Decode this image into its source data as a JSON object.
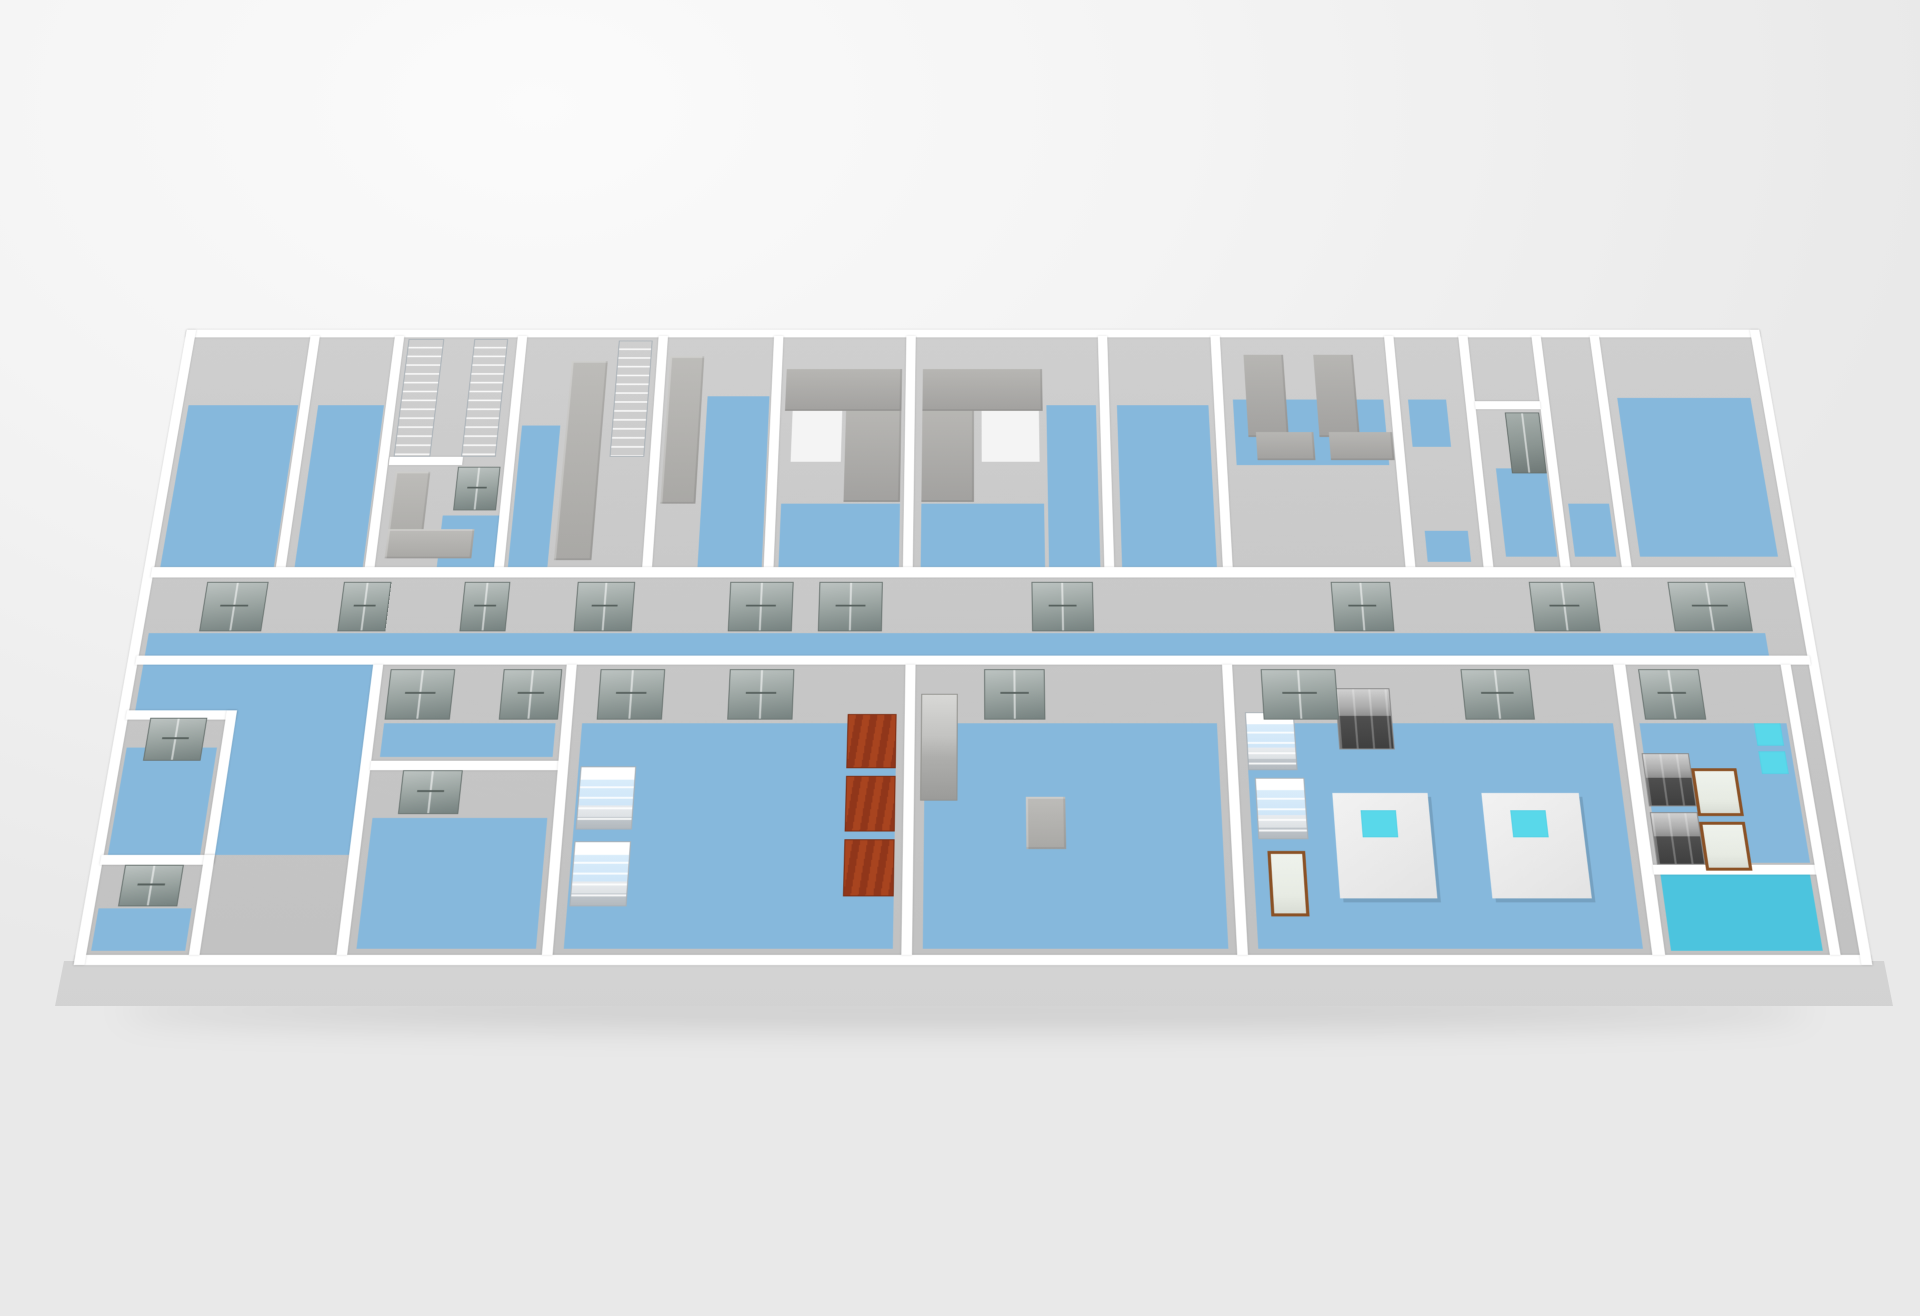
{
  "meta": {
    "view": "isometric-floor-plan",
    "building": "laboratory-floor"
  },
  "palette": {
    "wall": "#ffffff",
    "blue": "#86b8dc",
    "teal": "#4cc4de",
    "cyan": "#59d8ea",
    "wood": "#8a5125",
    "floor": "#c9c9c9",
    "door": "#97a19e",
    "red_shelf": "#a8441f",
    "background": "#f2f2f2"
  },
  "scene": {
    "plan_width": 1678,
    "plan_height": 710,
    "shapes": [
      {
        "name": "floor-base",
        "cls": "floor-base",
        "x": 10,
        "y": 10,
        "w": 1658,
        "h": 690
      },
      {
        "name": "room-a-floor",
        "cls": "blue",
        "x": 16,
        "y": 95,
        "w": 115,
        "h": 193
      },
      {
        "name": "room-b-floor",
        "cls": "blue",
        "x": 152,
        "y": 95,
        "w": 69,
        "h": 193
      },
      {
        "name": "room-c-floor",
        "cls": "blue",
        "x": 296,
        "y": 228,
        "w": 58,
        "h": 60
      },
      {
        "name": "room-d-floor",
        "cls": "blue",
        "x": 368,
        "y": 120,
        "w": 40,
        "h": 168
      },
      {
        "name": "room-e-floor",
        "cls": "blue",
        "x": 560,
        "y": 84,
        "w": 65,
        "h": 204
      },
      {
        "name": "room-f-floor",
        "cls": "blue",
        "x": 642,
        "y": 214,
        "w": 122,
        "h": 74
      },
      {
        "name": "room-g-floor",
        "cls": "blue",
        "x": 786,
        "y": 214,
        "w": 126,
        "h": 74
      },
      {
        "name": "room-g2-floor",
        "cls": "blue",
        "x": 916,
        "y": 95,
        "w": 52,
        "h": 193
      },
      {
        "name": "room-h-floor",
        "cls": "blue",
        "x": 990,
        "y": 95,
        "w": 96,
        "h": 193
      },
      {
        "name": "room-i-rug",
        "cls": "rug",
        "x": 1112,
        "y": 88,
        "w": 158,
        "h": 80
      },
      {
        "name": "room-j-rug",
        "cls": "rug",
        "x": 1296,
        "y": 88,
        "w": 40,
        "h": 58
      },
      {
        "name": "room-j-rug-south",
        "cls": "rug",
        "x": 1300,
        "y": 246,
        "w": 44,
        "h": 36
      },
      {
        "name": "room-k-floor",
        "cls": "blue",
        "x": 1380,
        "y": 172,
        "w": 52,
        "h": 104
      },
      {
        "name": "strip-room-rug",
        "cls": "rug",
        "x": 1450,
        "y": 214,
        "w": 42,
        "h": 62
      },
      {
        "name": "room-l-floor",
        "cls": "blue",
        "x": 1516,
        "y": 86,
        "w": 140,
        "h": 190
      },
      {
        "name": "corridor-floor",
        "cls": "blue",
        "x": 16,
        "y": 363,
        "w": 1614,
        "h": 25
      },
      {
        "name": "lobby-floor-north",
        "cls": "blue",
        "x": 16,
        "y": 398,
        "w": 228,
        "h": 50
      },
      {
        "name": "lobby-floor-south",
        "cls": "blue",
        "x": 116,
        "y": 448,
        "w": 128,
        "h": 152
      },
      {
        "name": "small-room-1-floor",
        "cls": "blue",
        "x": 14,
        "y": 488,
        "w": 88,
        "h": 112
      },
      {
        "name": "small-room-2-floor",
        "cls": "blue",
        "x": 14,
        "y": 654,
        "w": 88,
        "h": 42
      },
      {
        "name": "room-b1-floor",
        "cls": "blue",
        "x": 262,
        "y": 462,
        "w": 168,
        "h": 36
      },
      {
        "name": "room-b1s-floor",
        "cls": "blue",
        "x": 262,
        "y": 562,
        "w": 168,
        "h": 132
      },
      {
        "name": "room-b2-floor",
        "cls": "blue",
        "x": 456,
        "y": 462,
        "w": 308,
        "h": 232
      },
      {
        "name": "room-b3-floor",
        "cls": "blue",
        "x": 792,
        "y": 462,
        "w": 286,
        "h": 232
      },
      {
        "name": "room-b4-floor",
        "cls": "blue",
        "x": 1106,
        "y": 462,
        "w": 360,
        "h": 232
      },
      {
        "name": "room-b5-floor",
        "cls": "blue",
        "x": 1492,
        "y": 462,
        "w": 144,
        "h": 146
      },
      {
        "name": "room-b5-teal-floor",
        "cls": "teal",
        "x": 1492,
        "y": 620,
        "w": 142,
        "h": 76
      },
      {
        "name": "room-f-inner-patch",
        "cls": "white-patch",
        "x": 650,
        "y": 102,
        "w": 52,
        "h": 62
      },
      {
        "name": "room-g-inner-patch",
        "cls": "white-patch",
        "x": 848,
        "y": 102,
        "w": 60,
        "h": 62
      },
      {
        "name": "outer-wall-top",
        "cls": "wall",
        "x": 0,
        "y": 0,
        "w": 1678,
        "h": 10
      },
      {
        "name": "outer-wall-bottom",
        "cls": "wall",
        "x": 0,
        "y": 700,
        "w": 1678,
        "h": 10
      },
      {
        "name": "outer-wall-left",
        "cls": "wall",
        "x": 0,
        "y": 0,
        "w": 10,
        "h": 710
      },
      {
        "name": "outer-wall-right",
        "cls": "wall",
        "x": 1668,
        "y": 0,
        "w": 10,
        "h": 710
      },
      {
        "name": "wall-top-ab",
        "cls": "wall",
        "x": 133,
        "y": 8,
        "w": 10,
        "h": 280
      },
      {
        "name": "wall-top-bc",
        "cls": "wall",
        "x": 223,
        "y": 8,
        "w": 10,
        "h": 280
      },
      {
        "name": "wall-top-cd",
        "cls": "wall",
        "x": 354,
        "y": 8,
        "w": 10,
        "h": 280
      },
      {
        "name": "wall-top-de",
        "cls": "wall",
        "x": 504,
        "y": 8,
        "w": 10,
        "h": 280
      },
      {
        "name": "wall-top-ef",
        "cls": "wall",
        "x": 627,
        "y": 8,
        "w": 10,
        "h": 280
      },
      {
        "name": "wall-top-fg",
        "cls": "wall",
        "x": 768,
        "y": 8,
        "w": 10,
        "h": 280
      },
      {
        "name": "wall-top-gh",
        "cls": "wall",
        "x": 972,
        "y": 8,
        "w": 10,
        "h": 280
      },
      {
        "name": "wall-top-hi",
        "cls": "wall",
        "x": 1092,
        "y": 8,
        "w": 10,
        "h": 280
      },
      {
        "name": "wall-top-ij",
        "cls": "wall",
        "x": 1277,
        "y": 8,
        "w": 10,
        "h": 280
      },
      {
        "name": "wall-top-jk",
        "cls": "wall",
        "x": 1356,
        "y": 8,
        "w": 10,
        "h": 280
      },
      {
        "name": "wall-top-k-strip",
        "cls": "wall",
        "x": 1434,
        "y": 8,
        "w": 10,
        "h": 280
      },
      {
        "name": "wall-top-strip-l",
        "cls": "wall",
        "x": 1496,
        "y": 8,
        "w": 10,
        "h": 280
      },
      {
        "name": "wall-room-c-alcove",
        "cls": "wall",
        "x": 234,
        "y": 158,
        "w": 76,
        "h": 10
      },
      {
        "name": "wall-room-k-split",
        "cls": "wall",
        "x": 1366,
        "y": 90,
        "w": 68,
        "h": 10
      },
      {
        "name": "wall-corridor-north",
        "cls": "wall",
        "x": 8,
        "y": 288,
        "w": 1662,
        "h": 12
      },
      {
        "name": "wall-corridor-south",
        "cls": "wall",
        "x": 8,
        "y": 388,
        "w": 1662,
        "h": 10
      },
      {
        "name": "wall-small-room-top",
        "cls": "wall",
        "x": 8,
        "y": 448,
        "w": 108,
        "h": 10
      },
      {
        "name": "wall-small-room-right",
        "cls": "wall",
        "x": 106,
        "y": 448,
        "w": 10,
        "h": 160
      },
      {
        "name": "wall-small-room-mid",
        "cls": "wall",
        "x": 8,
        "y": 600,
        "w": 108,
        "h": 10
      },
      {
        "name": "wall-small-room2-right",
        "cls": "wall",
        "x": 106,
        "y": 600,
        "w": 10,
        "h": 100
      },
      {
        "name": "wall-bottom-lobby-b1",
        "cls": "wall",
        "x": 244,
        "y": 398,
        "w": 10,
        "h": 302
      },
      {
        "name": "wall-room-b1-split",
        "cls": "wall",
        "x": 254,
        "y": 502,
        "w": 182,
        "h": 10
      },
      {
        "name": "wall-bottom-b1-b2",
        "cls": "wall",
        "x": 436,
        "y": 398,
        "w": 10,
        "h": 302
      },
      {
        "name": "wall-bottom-b2-b3",
        "cls": "wall",
        "x": 772,
        "y": 398,
        "w": 10,
        "h": 302
      },
      {
        "name": "wall-bottom-b3-b4",
        "cls": "wall",
        "x": 1086,
        "y": 398,
        "w": 10,
        "h": 302
      },
      {
        "name": "wall-bottom-b4-b5",
        "cls": "wall",
        "x": 1474,
        "y": 398,
        "w": 12,
        "h": 302
      },
      {
        "name": "wall-room-b5-split",
        "cls": "wall",
        "x": 1486,
        "y": 610,
        "w": 154,
        "h": 10
      },
      {
        "name": "wall-bottom-b5-east",
        "cls": "wall",
        "x": 1640,
        "y": 398,
        "w": 10,
        "h": 302
      },
      {
        "name": "lab-fridge-column-1",
        "cls": "fridge-col",
        "x": 238,
        "y": 12,
        "w": 38,
        "h": 146
      },
      {
        "name": "lab-fridge-column-2",
        "cls": "fridge-col",
        "x": 308,
        "y": 12,
        "w": 36,
        "h": 146
      },
      {
        "name": "lab-fridge-column-3",
        "cls": "fridge-col",
        "x": 462,
        "y": 14,
        "w": 36,
        "h": 144
      },
      {
        "name": "room-c-counter-vertical",
        "cls": "counter",
        "x": 242,
        "y": 176,
        "w": 36,
        "h": 100
      },
      {
        "name": "room-c-counter-horizontal",
        "cls": "counter",
        "x": 242,
        "y": 244,
        "w": 88,
        "h": 34
      },
      {
        "name": "room-d-tall-counter",
        "cls": "counter",
        "x": 414,
        "y": 40,
        "w": 38,
        "h": 240
      },
      {
        "name": "room-e-tall-counter",
        "cls": "counter",
        "x": 518,
        "y": 34,
        "w": 36,
        "h": 180
      },
      {
        "name": "room-f-bench-block",
        "cls": "bench",
        "x": 642,
        "y": 50,
        "w": 122,
        "h": 52
      },
      {
        "name": "room-f-bench-side",
        "cls": "bench",
        "x": 706,
        "y": 102,
        "w": 58,
        "h": 110
      },
      {
        "name": "room-g-bench-block",
        "cls": "bench",
        "x": 786,
        "y": 50,
        "w": 126,
        "h": 52
      },
      {
        "name": "room-g-bench-side",
        "cls": "bench",
        "x": 786,
        "y": 102,
        "w": 54,
        "h": 110
      },
      {
        "name": "room-i-bench-1",
        "cls": "bench",
        "x": 1126,
        "y": 32,
        "w": 42,
        "h": 102
      },
      {
        "name": "room-i-bench-1-foot",
        "cls": "bench",
        "x": 1134,
        "y": 128,
        "w": 60,
        "h": 34
      },
      {
        "name": "room-i-bench-2",
        "cls": "bench",
        "x": 1200,
        "y": 32,
        "w": 42,
        "h": 102
      },
      {
        "name": "room-i-bench-2-foot",
        "cls": "bench",
        "x": 1210,
        "y": 128,
        "w": 66,
        "h": 34
      },
      {
        "name": "room-k-cabinet",
        "cls": "cabinet",
        "x": 1396,
        "y": 104,
        "w": 36,
        "h": 74
      },
      {
        "name": "room-b2-fridge-1",
        "cls": "fridge",
        "x": 458,
        "y": 508,
        "w": 54,
        "h": 66
      },
      {
        "name": "room-b2-fridge-2",
        "cls": "fridge",
        "x": 458,
        "y": 586,
        "w": 54,
        "h": 66
      },
      {
        "name": "room-b2-red-shelf-1",
        "cls": "red-shelf",
        "x": 716,
        "y": 452,
        "w": 48,
        "h": 58
      },
      {
        "name": "room-b2-red-shelf-2",
        "cls": "red-shelf",
        "x": 716,
        "y": 518,
        "w": 48,
        "h": 58
      },
      {
        "name": "room-b2-red-shelf-3",
        "cls": "red-shelf",
        "x": 716,
        "y": 584,
        "w": 48,
        "h": 58
      },
      {
        "name": "room-b3-cabinet",
        "cls": "steel-cab",
        "x": 788,
        "y": 430,
        "w": 36,
        "h": 114
      },
      {
        "name": "room-b3-table",
        "cls": "counter",
        "x": 890,
        "y": 540,
        "w": 38,
        "h": 54
      },
      {
        "name": "room-b4-fridge-1",
        "cls": "fridge",
        "x": 1106,
        "y": 450,
        "w": 48,
        "h": 62
      },
      {
        "name": "room-b4-fridge-2",
        "cls": "fridge",
        "x": 1112,
        "y": 520,
        "w": 48,
        "h": 64
      },
      {
        "name": "room-b4-steel-counter",
        "cls": "steel",
        "x": 1196,
        "y": 424,
        "w": 54,
        "h": 66
      },
      {
        "name": "room-b4-table-1",
        "cls": "table",
        "x": 1186,
        "y": 536,
        "w": 92,
        "h": 108
      },
      {
        "name": "room-b4-table-1-cyan-top",
        "cls": "cyan",
        "x": 1212,
        "y": 554,
        "w": 34,
        "h": 28
      },
      {
        "name": "room-b4-table-2",
        "cls": "table",
        "x": 1330,
        "y": 536,
        "w": 94,
        "h": 108
      },
      {
        "name": "room-b4-table-2-cyan-top",
        "cls": "cyan",
        "x": 1356,
        "y": 554,
        "w": 34,
        "h": 28
      },
      {
        "name": "room-b4-wood-case",
        "cls": "wood-case",
        "x": 1120,
        "y": 596,
        "w": 36,
        "h": 66
      },
      {
        "name": "room-b5-steel-drawers-1",
        "cls": "steel",
        "x": 1490,
        "y": 494,
        "w": 46,
        "h": 56
      },
      {
        "name": "room-b5-steel-drawers-2",
        "cls": "steel",
        "x": 1490,
        "y": 556,
        "w": 46,
        "h": 54
      },
      {
        "name": "room-b5-wood-case-1",
        "cls": "wood-case",
        "x": 1536,
        "y": 510,
        "w": 44,
        "h": 50
      },
      {
        "name": "room-b5-wood-case-2",
        "cls": "wood-case",
        "x": 1536,
        "y": 566,
        "w": 44,
        "h": 50
      },
      {
        "name": "room-b5-wall-hatch-1",
        "cls": "cyan",
        "x": 1604,
        "y": 462,
        "w": 26,
        "h": 24
      },
      {
        "name": "room-b5-wall-hatch-2",
        "cls": "cyan",
        "x": 1604,
        "y": 492,
        "w": 26,
        "h": 24
      },
      {
        "name": "corridor-door-1",
        "cls": "door",
        "x": 66,
        "y": 305,
        "w": 62,
        "h": 56
      },
      {
        "name": "corridor-door-2",
        "cls": "door",
        "x": 204,
        "y": 305,
        "w": 48,
        "h": 56
      },
      {
        "name": "corridor-door-3",
        "cls": "door",
        "x": 326,
        "y": 305,
        "w": 46,
        "h": 56
      },
      {
        "name": "corridor-door-4",
        "cls": "door",
        "x": 440,
        "y": 305,
        "w": 58,
        "h": 56
      },
      {
        "name": "corridor-door-5",
        "cls": "door",
        "x": 594,
        "y": 305,
        "w": 64,
        "h": 56
      },
      {
        "name": "corridor-door-6",
        "cls": "door",
        "x": 684,
        "y": 305,
        "w": 64,
        "h": 56
      },
      {
        "name": "corridor-door-7",
        "cls": "door",
        "x": 898,
        "y": 305,
        "w": 62,
        "h": 56
      },
      {
        "name": "corridor-door-8",
        "cls": "door",
        "x": 1200,
        "y": 305,
        "w": 60,
        "h": 56
      },
      {
        "name": "corridor-door-9",
        "cls": "door",
        "x": 1400,
        "y": 305,
        "w": 66,
        "h": 56
      },
      {
        "name": "corridor-door-10",
        "cls": "door",
        "x": 1540,
        "y": 305,
        "w": 78,
        "h": 56
      },
      {
        "name": "small-room-1-door",
        "cls": "door",
        "x": 32,
        "y": 456,
        "w": 56,
        "h": 46
      },
      {
        "name": "small-room-2-door",
        "cls": "door",
        "x": 32,
        "y": 610,
        "w": 56,
        "h": 42
      },
      {
        "name": "room-b1-door-1",
        "cls": "door",
        "x": 262,
        "y": 403,
        "w": 64,
        "h": 55
      },
      {
        "name": "room-b1-door-2",
        "cls": "door",
        "x": 374,
        "y": 403,
        "w": 58,
        "h": 55
      },
      {
        "name": "room-b1-inner-door",
        "cls": "door",
        "x": 286,
        "y": 512,
        "w": 58,
        "h": 46
      },
      {
        "name": "room-b2-door-1",
        "cls": "door",
        "x": 470,
        "y": 403,
        "w": 64,
        "h": 55
      },
      {
        "name": "room-b2-door-2",
        "cls": "door",
        "x": 598,
        "y": 403,
        "w": 64,
        "h": 55
      },
      {
        "name": "room-b3-door",
        "cls": "door",
        "x": 850,
        "y": 403,
        "w": 60,
        "h": 55
      },
      {
        "name": "room-b4-door-1",
        "cls": "door",
        "x": 1124,
        "y": 403,
        "w": 74,
        "h": 55
      },
      {
        "name": "room-b4-door-2",
        "cls": "door",
        "x": 1322,
        "y": 403,
        "w": 68,
        "h": 55
      },
      {
        "name": "room-b5-door",
        "cls": "door",
        "x": 1498,
        "y": 403,
        "w": 60,
        "h": 55
      },
      {
        "name": "room-c-inner-door",
        "cls": "door",
        "x": 306,
        "y": 170,
        "w": 44,
        "h": 52
      }
    ]
  }
}
